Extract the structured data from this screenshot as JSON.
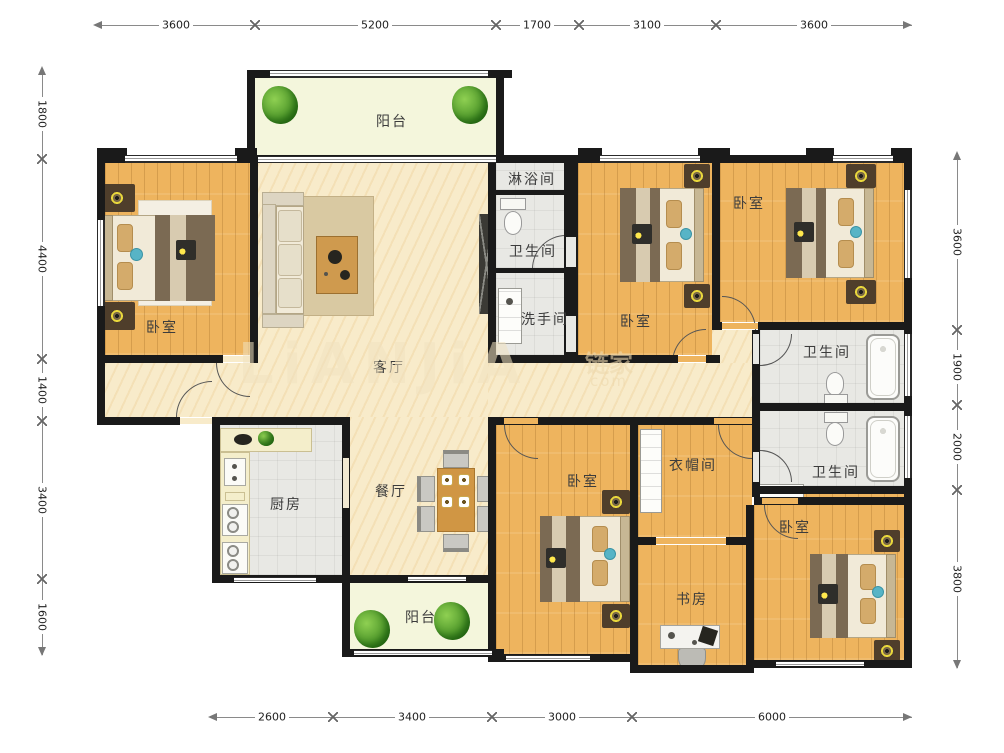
{
  "title": "户型图",
  "watermark": {
    "brand": "LiANJiA",
    "logo": "链家",
    "suffix": "com"
  },
  "dims": {
    "top": [
      "3600",
      "5200",
      "1700",
      "3100",
      "3600"
    ],
    "bottom": [
      "2600",
      "3400",
      "3000",
      "6000"
    ],
    "left": [
      "1800",
      "4400",
      "1400",
      "3400",
      "1600"
    ],
    "right": [
      "3600",
      "1900",
      "2000",
      "3800"
    ]
  },
  "rooms": {
    "balcony_top": {
      "label": "阳台"
    },
    "bedroom_tl": {
      "label": "卧室"
    },
    "living": {
      "label": "客厅"
    },
    "shower": {
      "label": "淋浴间"
    },
    "bathroom_mid": {
      "label": "卫生间"
    },
    "washroom": {
      "label": "洗手间"
    },
    "bedroom_top_mid": {
      "label": "卧室"
    },
    "bedroom_top_right": {
      "label": "卧室"
    },
    "bathroom_right_1": {
      "label": "卫生间"
    },
    "bathroom_right_2": {
      "label": "卫生间"
    },
    "kitchen": {
      "label": "厨房"
    },
    "dining": {
      "label": "餐厅"
    },
    "balcony_bottom": {
      "label": "阳台"
    },
    "bedroom_center": {
      "label": "卧室"
    },
    "cloakroom": {
      "label": "衣帽间"
    },
    "study": {
      "label": "书房"
    },
    "bedroom_bottom_right": {
      "label": "卧室"
    }
  },
  "colors": {
    "wall": "#1a1a1a",
    "wood_floor": "#eeb45e",
    "marble_floor": "#f8ebca",
    "tile_floor": "#e8e8e4",
    "balcony_floor": "#f4f6dc",
    "plant_green": "#4a9427",
    "bed_quilt": "#7b6a53",
    "accent_teal": "#57b4c6",
    "lamp_yellow": "#ead83c",
    "table_wood": "#d09644",
    "dimension_text": "#222222"
  }
}
